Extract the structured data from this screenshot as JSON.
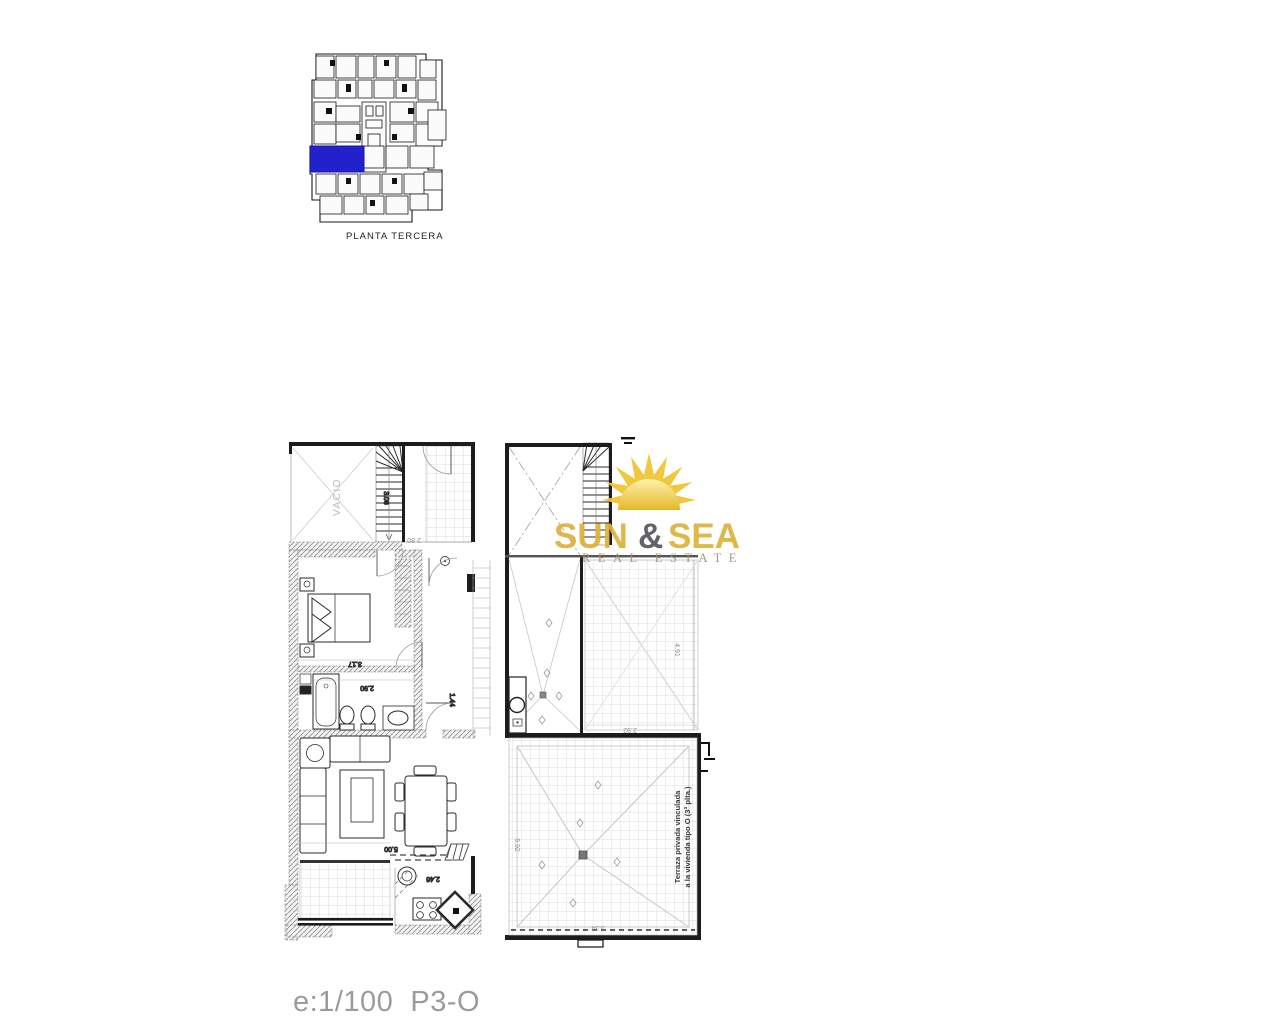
{
  "key_plan": {
    "label": "PLANTA TERCERA",
    "highlight_color": "#2222cc"
  },
  "logo": {
    "word_sun": "SUN",
    "ampersand": "&",
    "word_sea": "SEA",
    "subtitle": "REAL ESTATE",
    "gold": "#ddb23a",
    "dark_gray": "#56565c"
  },
  "left_plan": {
    "vacio_label": "VACIO",
    "dimensions": {
      "hall_top": "2.80",
      "stairs": "3.06",
      "bedroom": "3.17",
      "bathroom": "2.90",
      "hall": "1.44",
      "living": "5.00",
      "kitchen": "2.46"
    }
  },
  "right_plan": {
    "terrace_note_line1": "Terraza privada vinculada",
    "terrace_note_line2": "a la vivienda tipo O (3ª plta.)",
    "dimensions": {
      "upper_terrace_h": "4.91",
      "upper_terrace_w": "2.92",
      "main_terrace_w": "5.34",
      "main_terrace_h": "5.92"
    }
  },
  "footer": {
    "scale": "e:1/100  P3-O"
  }
}
